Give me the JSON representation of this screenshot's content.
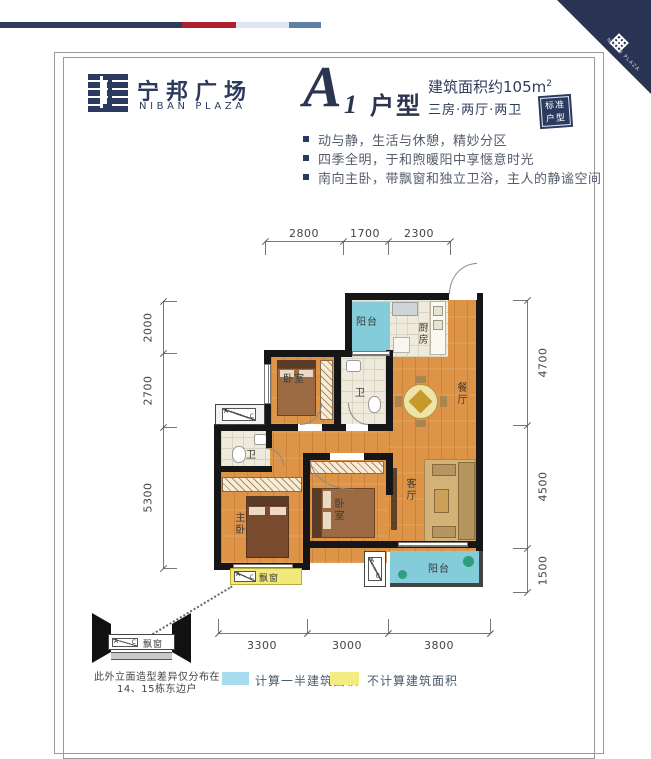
{
  "brand": {
    "cn": "宁邦广场",
    "en": "NIBAN PLAZA"
  },
  "corner": {
    "en": "NIBAN PLAZA"
  },
  "header": {
    "unit_letter": "A",
    "unit_number": "1",
    "unit_suffix": "户型",
    "area": "建筑面积约105m",
    "area_sup": "2",
    "layout": "三房·两厅·两卫",
    "badge_line1": "标准",
    "badge_line2": "户型"
  },
  "highlights": [
    {
      "text": "动与静，生活与休憩，精妙分区"
    },
    {
      "text": "四季全明，于和煦暖阳中享惬意时光"
    },
    {
      "text": "南向主卧，带飘窗和独立卫浴，主人的静谧空间"
    }
  ],
  "floorplan": {
    "dims": {
      "top": [
        "2800",
        "1700",
        "2300"
      ],
      "left": [
        "2000",
        "2700",
        "5300"
      ],
      "right": [
        "4700",
        "4500",
        "1500"
      ],
      "bottom": [
        "3300",
        "3000",
        "3800"
      ]
    },
    "rooms": {
      "balcony_top": "阳台",
      "kitchen": "厨房",
      "bedroom_top": "卧室",
      "bath_top": "卫",
      "dining": "餐厅",
      "bath_master": "卫",
      "master": "主卧",
      "bedroom_mid": "卧室",
      "living": "客厅",
      "balcony_bottom": "阳台",
      "bay_window": "飘窗"
    },
    "ac": {
      "a": "A",
      "c": "C"
    }
  },
  "detail": {
    "label": "飘窗",
    "note1": "此外立面造型差异仅分布在",
    "note2": "14、15栋东边户"
  },
  "legend": [
    {
      "color": "#a6dcee",
      "label": "计算一半建筑面积"
    },
    {
      "color": "#f4ec82",
      "label": "不计算建筑面积"
    }
  ],
  "colors": {
    "navy": "#2b3a5e",
    "red": "#b01f30",
    "pale_blue": "#dde6f2",
    "steel_blue": "#5d80a4"
  }
}
